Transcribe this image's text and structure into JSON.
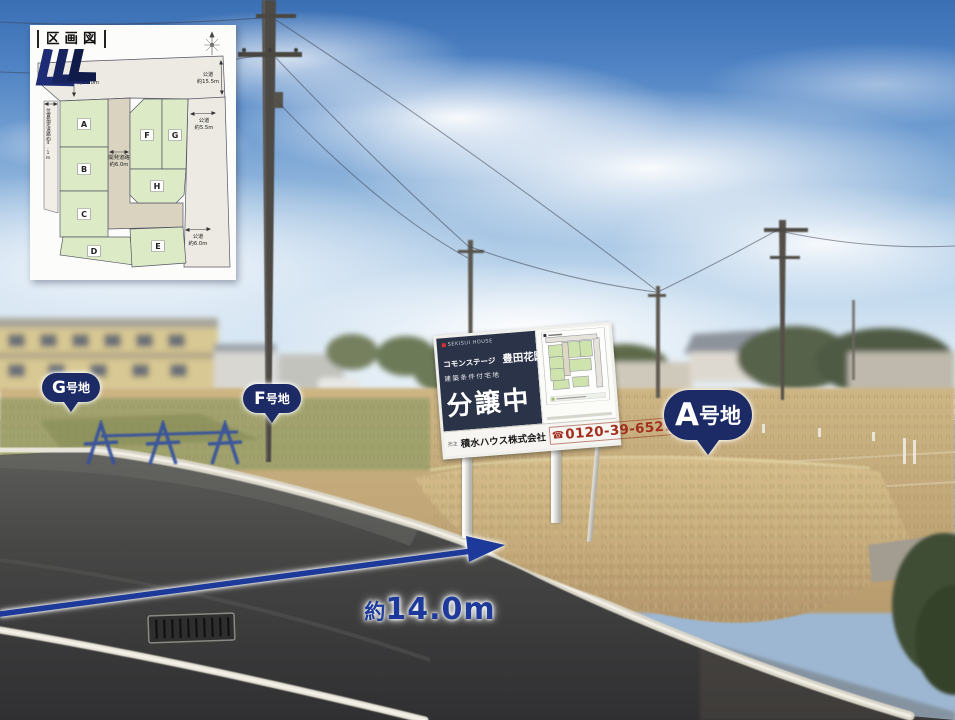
{
  "inset_map": {
    "title": "区画図",
    "lots": {
      "a": "A",
      "b": "B",
      "c": "C",
      "d": "D",
      "e": "E",
      "f": "F",
      "g": "G",
      "h": "H"
    },
    "roads": {
      "top": [
        "公道",
        "約14.0m"
      ],
      "right_top": [
        "公道",
        "約15.5m"
      ],
      "right_mid": [
        "公道",
        "約5.5m"
      ],
      "right_bottom": [
        "公道",
        "約6.0m"
      ],
      "left": "位置指定道路約4.1m",
      "center": [
        "開発道路",
        "約6.0m"
      ]
    }
  },
  "bubbles": [
    {
      "letter": "G",
      "suffix": "号地"
    },
    {
      "letter": "F",
      "suffix": "号地"
    },
    {
      "letter": "A",
      "suffix": "号地"
    }
  ],
  "billboard": {
    "brand": "SEKISUI HOUSE",
    "series": "コモンステージ",
    "project": "豊田花園",
    "condition": "建築条件付宅地",
    "status": "分譲中",
    "seller_label": "売主",
    "company": "積水ハウス株式会社",
    "phone_icon": "☎",
    "phone": "0120-39-6521"
  },
  "measurement": {
    "prefix": "約",
    "value": "14.0m"
  },
  "colors": {
    "bubble_navy": "#1c2b66",
    "arrow_blue": "#1d3a9a",
    "sign_navy": "#2a3347",
    "phone_red": "#a32e1d",
    "lot_green": "#dceac6",
    "road_gray": "#eceae3",
    "road_tan": "#d9d3bf"
  }
}
